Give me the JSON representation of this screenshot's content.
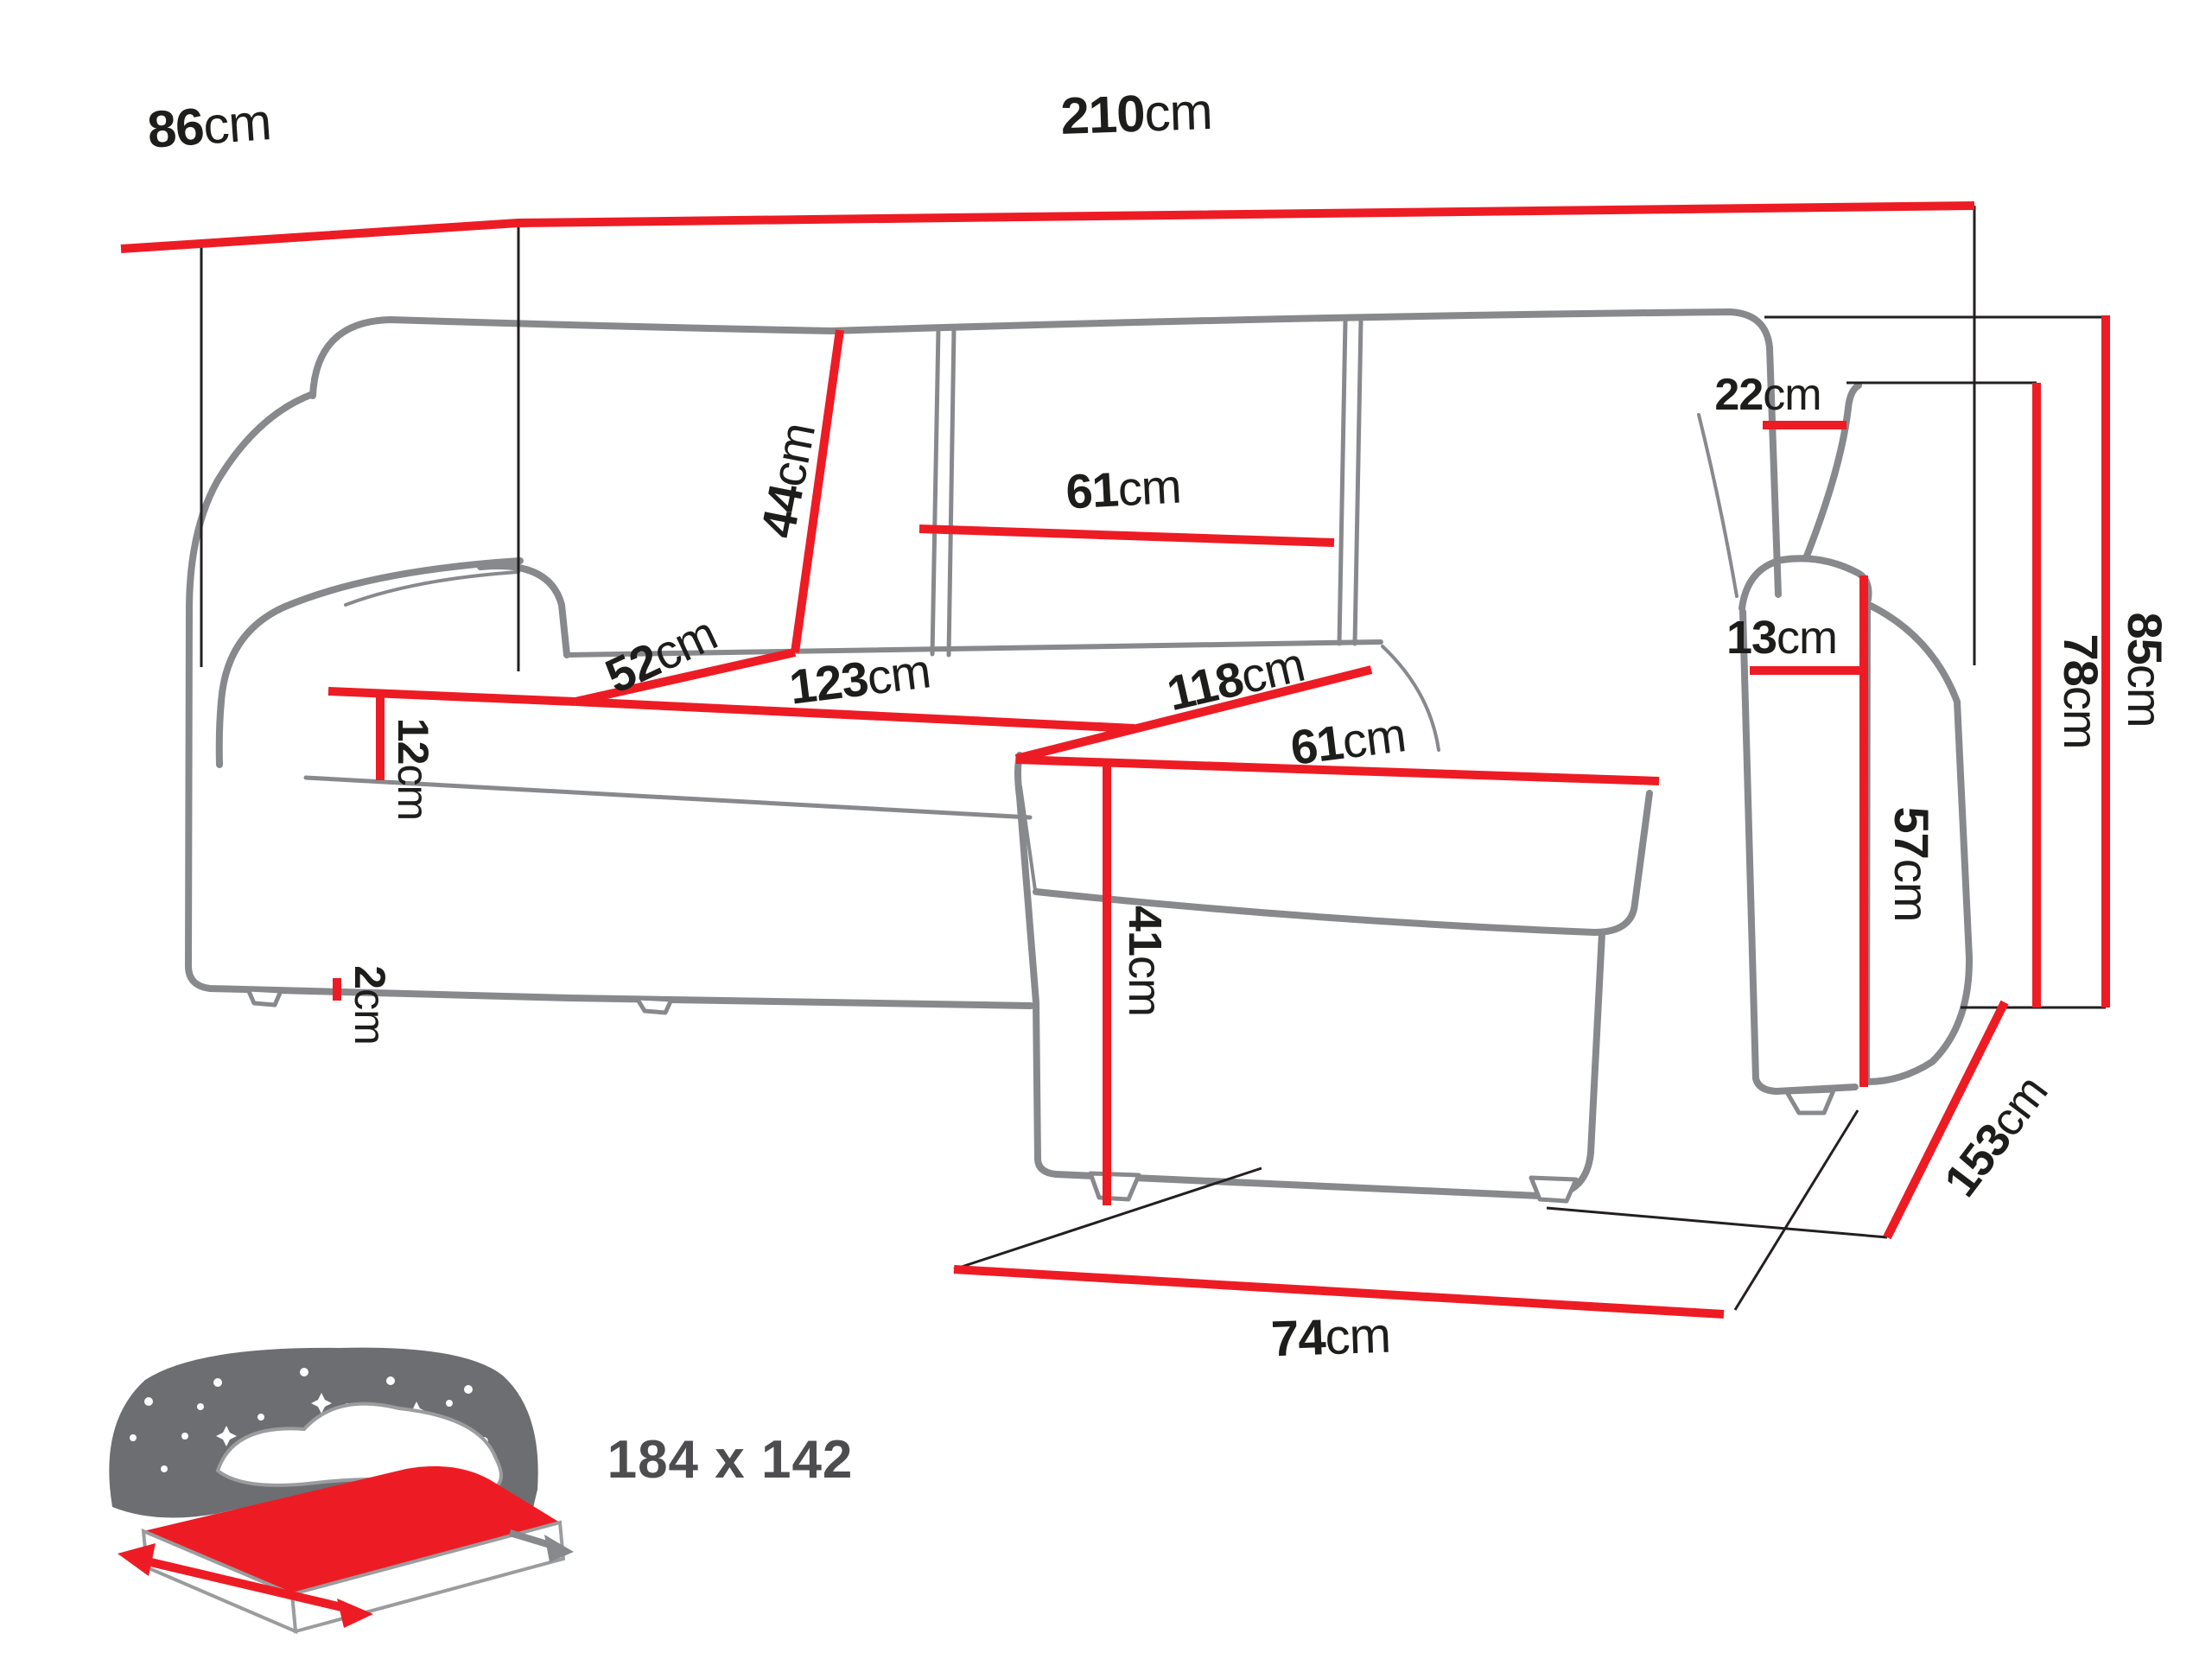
{
  "labels": {
    "back_depth": {
      "value": "86",
      "unit": "cm"
    },
    "total_width": {
      "value": "210",
      "unit": "cm"
    },
    "backrest_top_gap": {
      "value": "22",
      "unit": "cm"
    },
    "back_cushion_height": {
      "value": "44",
      "unit": "cm"
    },
    "back_cushion_width": {
      "value": "61",
      "unit": "cm"
    },
    "seat_depth_side": {
      "value": "52",
      "unit": "cm"
    },
    "seat_width": {
      "value": "123",
      "unit": "cm"
    },
    "chaise_length": {
      "value": "118",
      "unit": "cm"
    },
    "chaise_width": {
      "value": "61",
      "unit": "cm"
    },
    "seat_board_height": {
      "value": "12",
      "unit": "cm"
    },
    "foot_height": {
      "value": "2",
      "unit": "cm"
    },
    "chaise_height": {
      "value": "41",
      "unit": "cm"
    },
    "armrest_width": {
      "value": "13",
      "unit": "cm"
    },
    "armrest_height": {
      "value": "57",
      "unit": "cm"
    },
    "arm_total_height": {
      "value": "78",
      "unit": "cm"
    },
    "total_height": {
      "value": "85",
      "unit": "cm"
    },
    "total_depth": {
      "value": "153",
      "unit": "cm"
    },
    "floor_front_depth": {
      "value": "74",
      "unit": "cm"
    }
  },
  "bed": {
    "size_label": "184 x 142"
  },
  "colors": {
    "dimension_red": "#ed1c24",
    "outline_gray": "#87898c",
    "thin_black": "#231f20",
    "text": "#1d1d1b",
    "icon_gray": "#6d6e71"
  }
}
